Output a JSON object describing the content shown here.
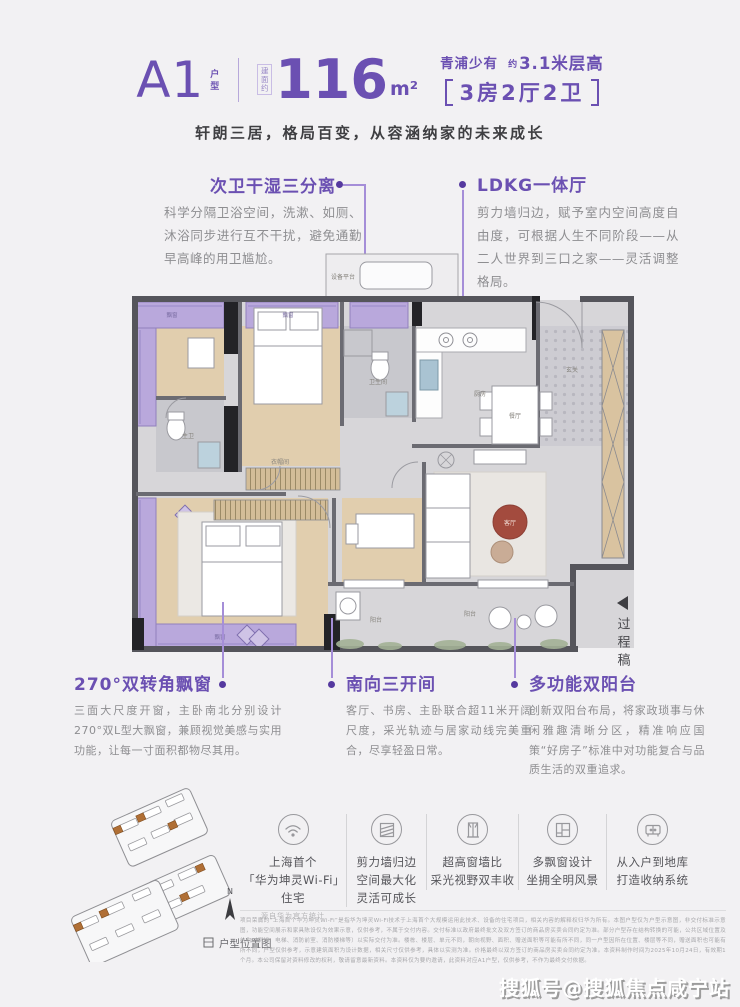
{
  "page": {
    "bg": "#f2f1f3",
    "accent_purple": "#6b50b2",
    "bay_purple": "#b9a8dc",
    "highlight_orange": "#b06f35"
  },
  "header": {
    "plan_code": "A1",
    "plan_code_suffix": "户型",
    "area_prefix": "建面约",
    "area_value": "116",
    "area_unit": "m²",
    "tagline_location": "青浦少有",
    "tagline_approx": "约",
    "tagline_height": "3.1米层高",
    "layout_spec": "3房2厅2卫",
    "subtitle": "轩朗三居，格局百变，从容涵纳家的未来成长"
  },
  "callouts": {
    "sub_bath": {
      "title": "次卫干湿三分离",
      "desc": "科学分隔卫浴空间，洗漱、如厕、沐浴同步进行互不干扰，避免通勤早高峰的用卫尴尬。"
    },
    "ldkg": {
      "title": "LDKG一体厅",
      "desc": "剪力墙归边，赋予室内空间高度自由度，可根据人生不同阶段——从二人世界到三口之家——灵活调整格局。"
    },
    "bay_window": {
      "title": "270°双转角飘窗",
      "desc": "三面大尺度开窗，主卧南北分别设计270°双L型大飘窗，兼顾视觉美感与实用功能，让每一寸面积都物尽其用。"
    },
    "south_bays": {
      "title": "南向三开间",
      "desc": "客厅、书房、主卧联合超11米开阔尺度，采光轨迹与居家动线完美重合，尽享轻盈日常。"
    },
    "dual_balcony": {
      "title": "多功能双阳台",
      "desc": "创新双阳台布局，将家政琐事与休闲雅趣清晰分区，精准响应国策“好房子”标准中对功能复合与品质生活的双重追求。"
    }
  },
  "floorplan": {
    "draft_note": "过程稿",
    "rooms": {
      "equipment": "设备平台",
      "bay_a": "飘窗",
      "bay_b": "飘窗",
      "bay_master": "飘窗",
      "master_bath": "主卫",
      "bath": "卫生间",
      "kitchen": "厨房",
      "foyer": "玄关",
      "dining": "餐厅",
      "living": "客厅",
      "closet": "衣帽间",
      "balcony_service": "阳台",
      "balcony_leisure": "阳台"
    }
  },
  "features": [
    {
      "icon": "wifi-icon",
      "lines": [
        "上海首个",
        "「华为坤灵Wi-Fi」",
        "住宅"
      ],
      "note": "源自华为官方统计"
    },
    {
      "icon": "shear-wall-icon",
      "lines": [
        "剪力墙归边",
        "空间最大化",
        "灵活可成长"
      ]
    },
    {
      "icon": "window-ratio-icon",
      "lines": [
        "超高窗墙比",
        "采光视野双丰收"
      ]
    },
    {
      "icon": "bay-window-icon",
      "lines": [
        "多飘窗设计",
        "坐拥全明风景"
      ]
    },
    {
      "icon": "storage-icon",
      "lines": [
        "从入户到地库",
        "打造收纳系统"
      ]
    }
  ],
  "siteplan": {
    "caption": "户型位置图",
    "compass_label": "N"
  },
  "disclaimer": "项目荣膺的“上海首个华为坤灵Wi-Fi”是指华为坤灵Wi-Fi技术于上海首个大规模运用此技术、设备的住宅项目，相关内容的解释权归华为所有。本图户型仅为户型示意图，非交付标准示意图，功能空间展示和家具陈设仅为效果示意，仅供参考，不属于交付内容。交付标准以政府最终批文及双方签订的商品房买卖合同约定为准。部分户型存在结构转换的可能，公共区域位置及结构（例如：电梯、消防前室、消防楼梯等）以实际交付为准。楼栋、楼层、单元不同，朝向视野、面积、赠送面积等可能有所不同，同一户型因所在位置、楼层等不同，赠送面积也可能有所不同，户型仅供参考，示意建筑面积为设计数据，相关尺寸仅供参考，具体以实测为准。价格最终以双方签订的商品房买卖合同约定为准。本资料制作时间为2025年10月24日，有效期1个月。本公司保留对资料修改的权利，敬请留意最新资料。本资料仅为要约邀请，此资料对应A1户型，仅供参考，不作为最终交付依据。",
  "watermark": "搜狐号@搜狐焦点咸宁站"
}
